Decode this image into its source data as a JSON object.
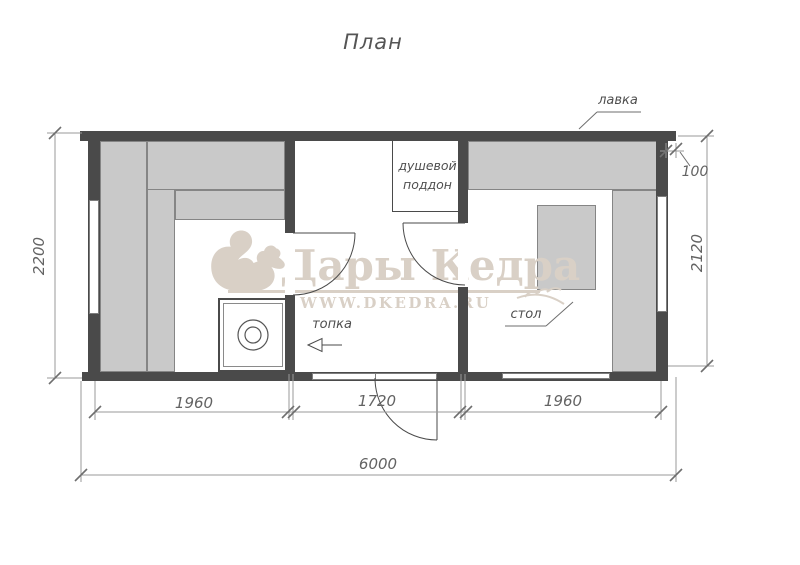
{
  "title": "План",
  "watermark": {
    "brand": "Дары Кедра",
    "site": "WWW.DKEDRA.RU"
  },
  "labels": {
    "bench": "лавка",
    "shower_line1": "душевой",
    "shower_line2": "поддон",
    "firebox": "топка",
    "table": "стол"
  },
  "dimensions": {
    "height_left": "2200",
    "height_right": "2120",
    "overhang": "100",
    "bottom_left": "1960",
    "bottom_middle": "1720",
    "bottom_right": "1960",
    "total_width": "6000"
  },
  "colors": {
    "wall": "#4a4a4a",
    "furniture": "#c9c9c9",
    "line": "#9a9a9a",
    "text": "#4f4f4f",
    "watermark": "#d9d0c6"
  }
}
